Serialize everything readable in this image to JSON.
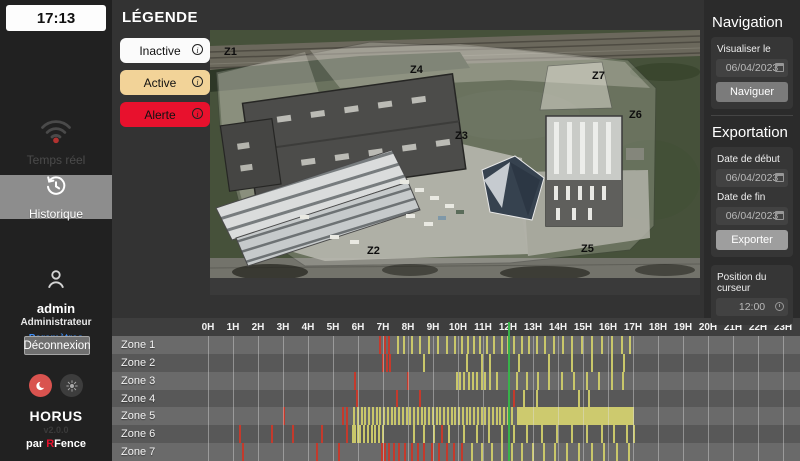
{
  "sidebar": {
    "time": "17:13",
    "items": [
      {
        "label": "Temps réel"
      },
      {
        "label": "Historique"
      }
    ],
    "user": {
      "name": "admin",
      "role": "Administrateur",
      "settings_label": "Paramètres"
    },
    "logout_label": "Déconnexion",
    "brand": {
      "name": "HORUS",
      "version": "v2.0.0",
      "byline_prefix": "par ",
      "byline_brand_r": "R",
      "byline_brand_rest": "Fence"
    }
  },
  "legend": {
    "title": "LÉGENDE",
    "items": [
      {
        "label": "Inactive",
        "color": "#fbfbfb"
      },
      {
        "label": "Active",
        "color": "#f2d398"
      },
      {
        "label": "Alerte",
        "color": "#e8112d"
      }
    ]
  },
  "map": {
    "zones": [
      {
        "id": "Z1",
        "x": 14,
        "y": 25
      },
      {
        "id": "Z4",
        "x": 200,
        "y": 43
      },
      {
        "id": "Z7",
        "x": 382,
        "y": 49
      },
      {
        "id": "Z6",
        "x": 419,
        "y": 88
      },
      {
        "id": "Z3",
        "x": 245,
        "y": 109
      },
      {
        "id": "Z2",
        "x": 157,
        "y": 224
      },
      {
        "id": "Z5",
        "x": 371,
        "y": 222
      }
    ]
  },
  "nav_panel": {
    "title": "Navigation",
    "view_label": "Visualiser le",
    "view_date": "06/04/2023",
    "button_label": "Naviguer"
  },
  "export_panel": {
    "title": "Exportation",
    "start_label": "Date de début",
    "start_date": "06/04/2023",
    "end_label": "Date de fin",
    "end_date": "06/04/2023",
    "button_label": "Exporter"
  },
  "cursor_panel": {
    "label": "Position du curseur",
    "time": "12:00"
  },
  "timeline": {
    "hours": [
      "0H",
      "1H",
      "2H",
      "3H",
      "4H",
      "5H",
      "6H",
      "7H",
      "8H",
      "9H",
      "10H",
      "11H",
      "12H",
      "13H",
      "14H",
      "15H",
      "16H",
      "17H",
      "18H",
      "19H",
      "20H",
      "21H",
      "22H",
      "23H"
    ],
    "cursor_hour": 12,
    "colors": {
      "alert": "#c43a2c",
      "active": "#c9c76a",
      "cursor": "#38b24a"
    },
    "zones": [
      {
        "label": "Zone 1",
        "red": [
          6.85,
          7.05,
          7.2
        ],
        "yellow": [
          7.55,
          7.8,
          8.1,
          8.45,
          8.8,
          9.15,
          9.5,
          9.85,
          10.1,
          10.35,
          10.6,
          10.85,
          11.1,
          11.4,
          11.7,
          11.95,
          12.2,
          12.5,
          12.8,
          13.1,
          13.45,
          13.8,
          14.15,
          14.5,
          14.9,
          15.3,
          15.7,
          16.1,
          16.5,
          16.85
        ],
        "band": null
      },
      {
        "label": "Zone 2",
        "red": [
          6.95,
          7.1,
          7.25
        ],
        "yellow": [
          8.6,
          10.3,
          10.9,
          11.25,
          12.4,
          13.6,
          14.5,
          15.3,
          16.1,
          16.6
        ],
        "band": null
      },
      {
        "label": "Zone 3",
        "red": [
          5.85,
          7.95
        ],
        "yellow": [
          9.9,
          10.05,
          10.2,
          10.4,
          10.55,
          10.7,
          10.9,
          11.05,
          11.25,
          11.5,
          12.3,
          12.7,
          13.15,
          13.6,
          14.1,
          14.6,
          15.1,
          15.6,
          16.1,
          16.55
        ],
        "band": null
      },
      {
        "label": "Zone 4",
        "red": [
          5.9,
          7.5,
          8.45,
          12.2
        ],
        "yellow": [
          12.6,
          13.1,
          14.8,
          15.2
        ],
        "band": null
      },
      {
        "label": "Zone 5",
        "red": [
          3.0,
          5.35,
          5.5
        ],
        "yellow": [
          5.8,
          5.95,
          6.1,
          6.25,
          6.4,
          6.55,
          6.7,
          6.85,
          7.0,
          7.15,
          7.3,
          7.45,
          7.6,
          7.75,
          7.9,
          8.05,
          8.2,
          8.35,
          8.5,
          8.65,
          8.8,
          8.95,
          9.1,
          9.25,
          9.4,
          9.55,
          9.7,
          9.85,
          10.0,
          10.15,
          10.3,
          10.45,
          10.6,
          10.75,
          10.9,
          11.05,
          11.2,
          11.35,
          11.5,
          11.65,
          11.8,
          11.95,
          12.1
        ],
        "band": [
          12.35,
          17.05
        ]
      },
      {
        "label": "Zone 6",
        "red": [
          1.25,
          2.5,
          3.35,
          4.5,
          5.5,
          9.3
        ],
        "yellow": [
          5.75,
          5.85,
          5.95,
          6.05,
          6.2,
          6.35,
          6.5,
          6.65,
          6.8,
          6.95,
          8.2,
          8.6,
          9.0,
          9.6,
          10.2,
          10.7,
          11.2,
          11.7,
          12.2,
          12.7,
          13.3,
          13.9,
          14.5,
          15.1,
          15.7,
          16.2,
          16.7,
          17.0
        ],
        "band": null
      },
      {
        "label": "Zone 7",
        "red": [
          1.35,
          4.3,
          5.2,
          6.9,
          7.05,
          7.2,
          7.4,
          7.6,
          7.85,
          8.1,
          8.35,
          8.6,
          8.9,
          9.2,
          9.5,
          9.8,
          10.1
        ],
        "yellow": [
          10.5,
          10.9,
          11.3,
          11.7,
          12.1,
          12.5,
          12.95,
          13.4,
          13.85,
          14.3,
          14.8,
          15.3,
          15.8,
          16.3,
          16.8
        ],
        "band": null
      }
    ]
  }
}
